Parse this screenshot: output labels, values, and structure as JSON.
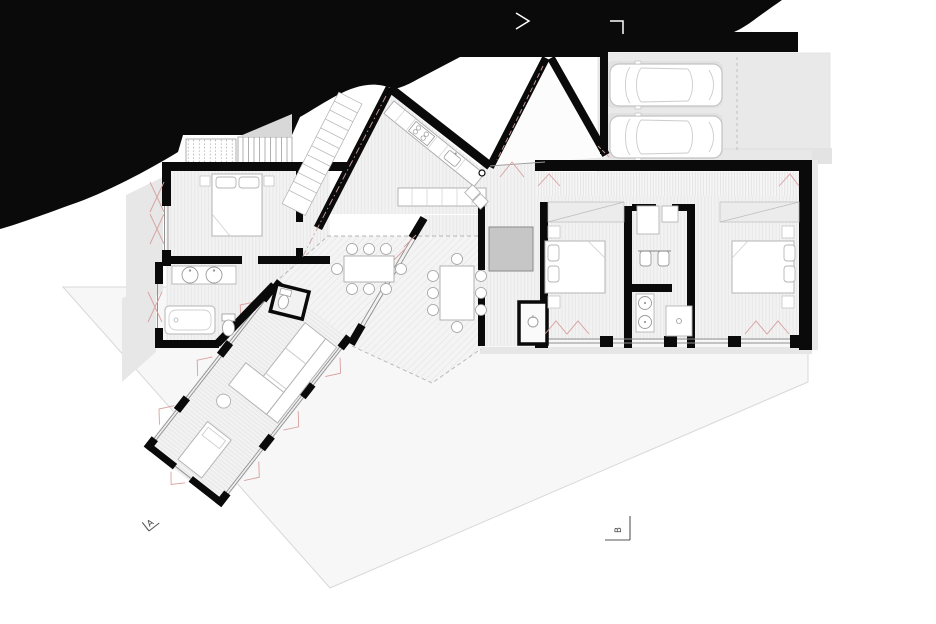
{
  "drawing": {
    "type": "architectural ground-floor plan",
    "section_markers": {
      "a_label": "A",
      "b_label": "B"
    },
    "visible_counts": {
      "cars": 2,
      "beds": 3,
      "indoor_dining_chairs": 8,
      "outdoor_dining_chairs": 8,
      "bath_sinks_left": 2,
      "bath_sinks_right": 2
    },
    "palette": {
      "terrain": "#0a0a0a",
      "walls": "#0a0a0a",
      "interior_floor": "#f2f2f2",
      "ground": "#f7f7f7",
      "carport_slab": "#e9e9e9",
      "shadow": "#e2e2e2",
      "storage_block": "#c6c6c6",
      "furniture_fill": "#ffffff",
      "furniture_stroke": "#b5b5b5",
      "glass_line": "#8f8f8f",
      "opening_marks": "#d8a0a0",
      "marker_stroke": "#555555",
      "marker_text": "#444444",
      "terrain_marks": "#ffffff"
    }
  }
}
